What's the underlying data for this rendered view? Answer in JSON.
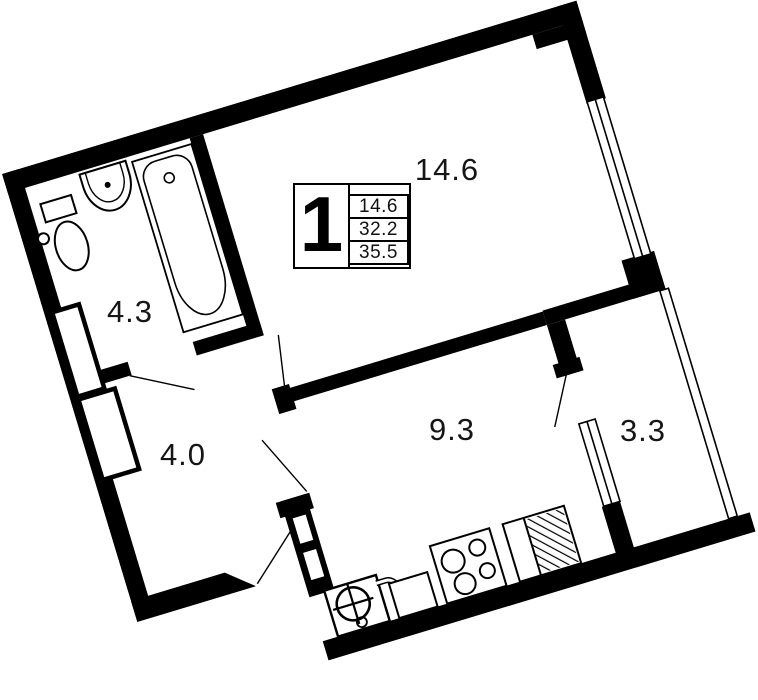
{
  "title": "1-room apartment floor plan",
  "colors": {
    "wall": "#000000",
    "text": "#161616",
    "background": "#ffffff"
  },
  "legend": {
    "room_count": "1",
    "areas": [
      "14.6",
      "32.2",
      "35.5"
    ]
  },
  "rooms": [
    {
      "name": "living-room",
      "area": "14.6"
    },
    {
      "name": "bathroom",
      "area": "4.3"
    },
    {
      "name": "hallway",
      "area": "4.0"
    },
    {
      "name": "kitchen",
      "area": "9.3"
    },
    {
      "name": "balcony",
      "area": "3.3"
    }
  ],
  "fixtures": [
    "toilet",
    "bathroom-sink",
    "bathtub",
    "kitchen-sink",
    "faucet",
    "stove",
    "appliance-hatched",
    "vent-shaft",
    "window",
    "balcony-glazing",
    "entrance-door"
  ]
}
